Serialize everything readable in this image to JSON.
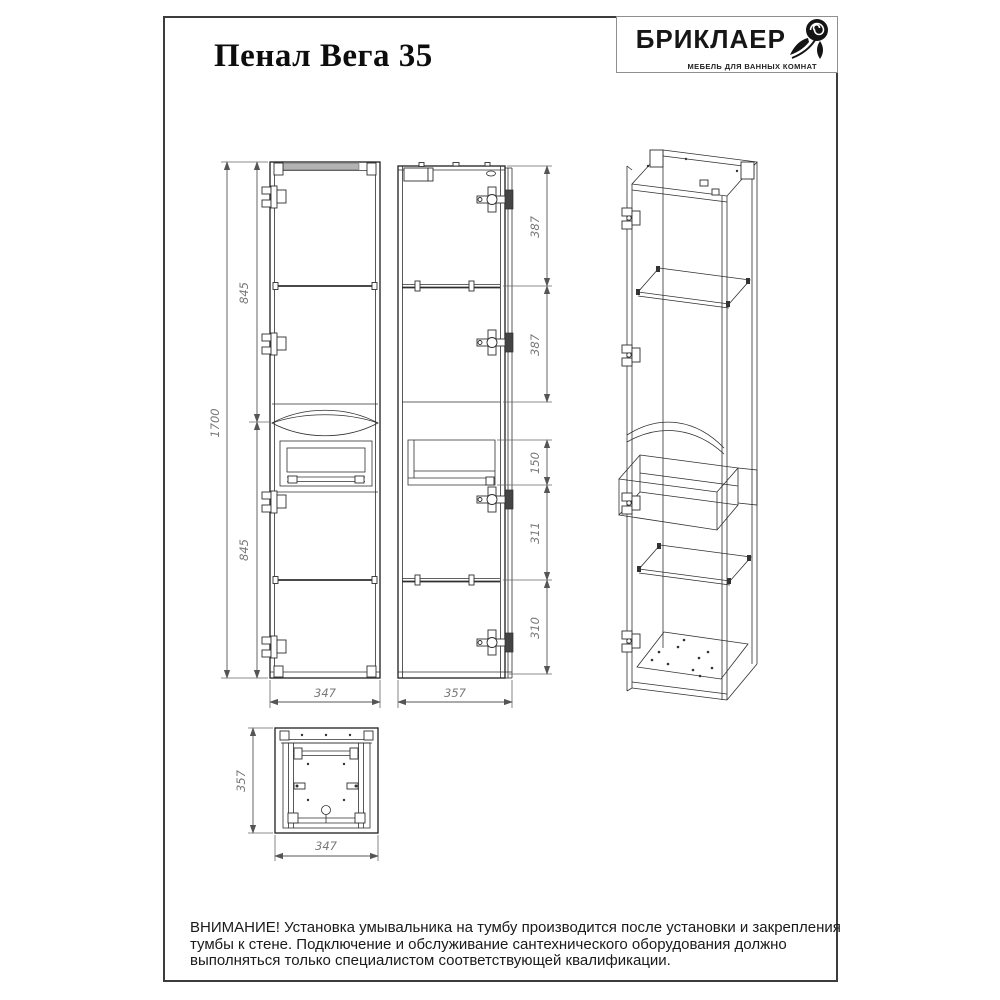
{
  "page": {
    "title": "Пенал Вега 35"
  },
  "brand": {
    "name": "БРИКЛАЕР",
    "tagline": "МЕБЕЛЬ ДЛЯ ВАННЫХ КОМНАТ"
  },
  "drawing": {
    "front_view": {
      "height_total": "1700",
      "height_upper": "845",
      "height_lower": "845",
      "width": "347"
    },
    "side_view": {
      "top_section": "387",
      "second_section": "387",
      "niche_height": "150",
      "below_niche": "311",
      "bottom_section": "310",
      "depth": "357"
    },
    "bottom_view": {
      "depth": "357",
      "width": "347"
    }
  },
  "warning": {
    "lines": [
      "ВНИМАНИЕ! Установка умывальника на тумбу производится после установки и закрепления",
      "тумбы к стене. Подключение и обслуживание сантехнического оборудования должно",
      "выполняться только специалистом соответствующей квалификации."
    ]
  },
  "colors": {
    "line": "#2f2f2f",
    "dimension": "#555555",
    "dim_text": "#777777"
  }
}
